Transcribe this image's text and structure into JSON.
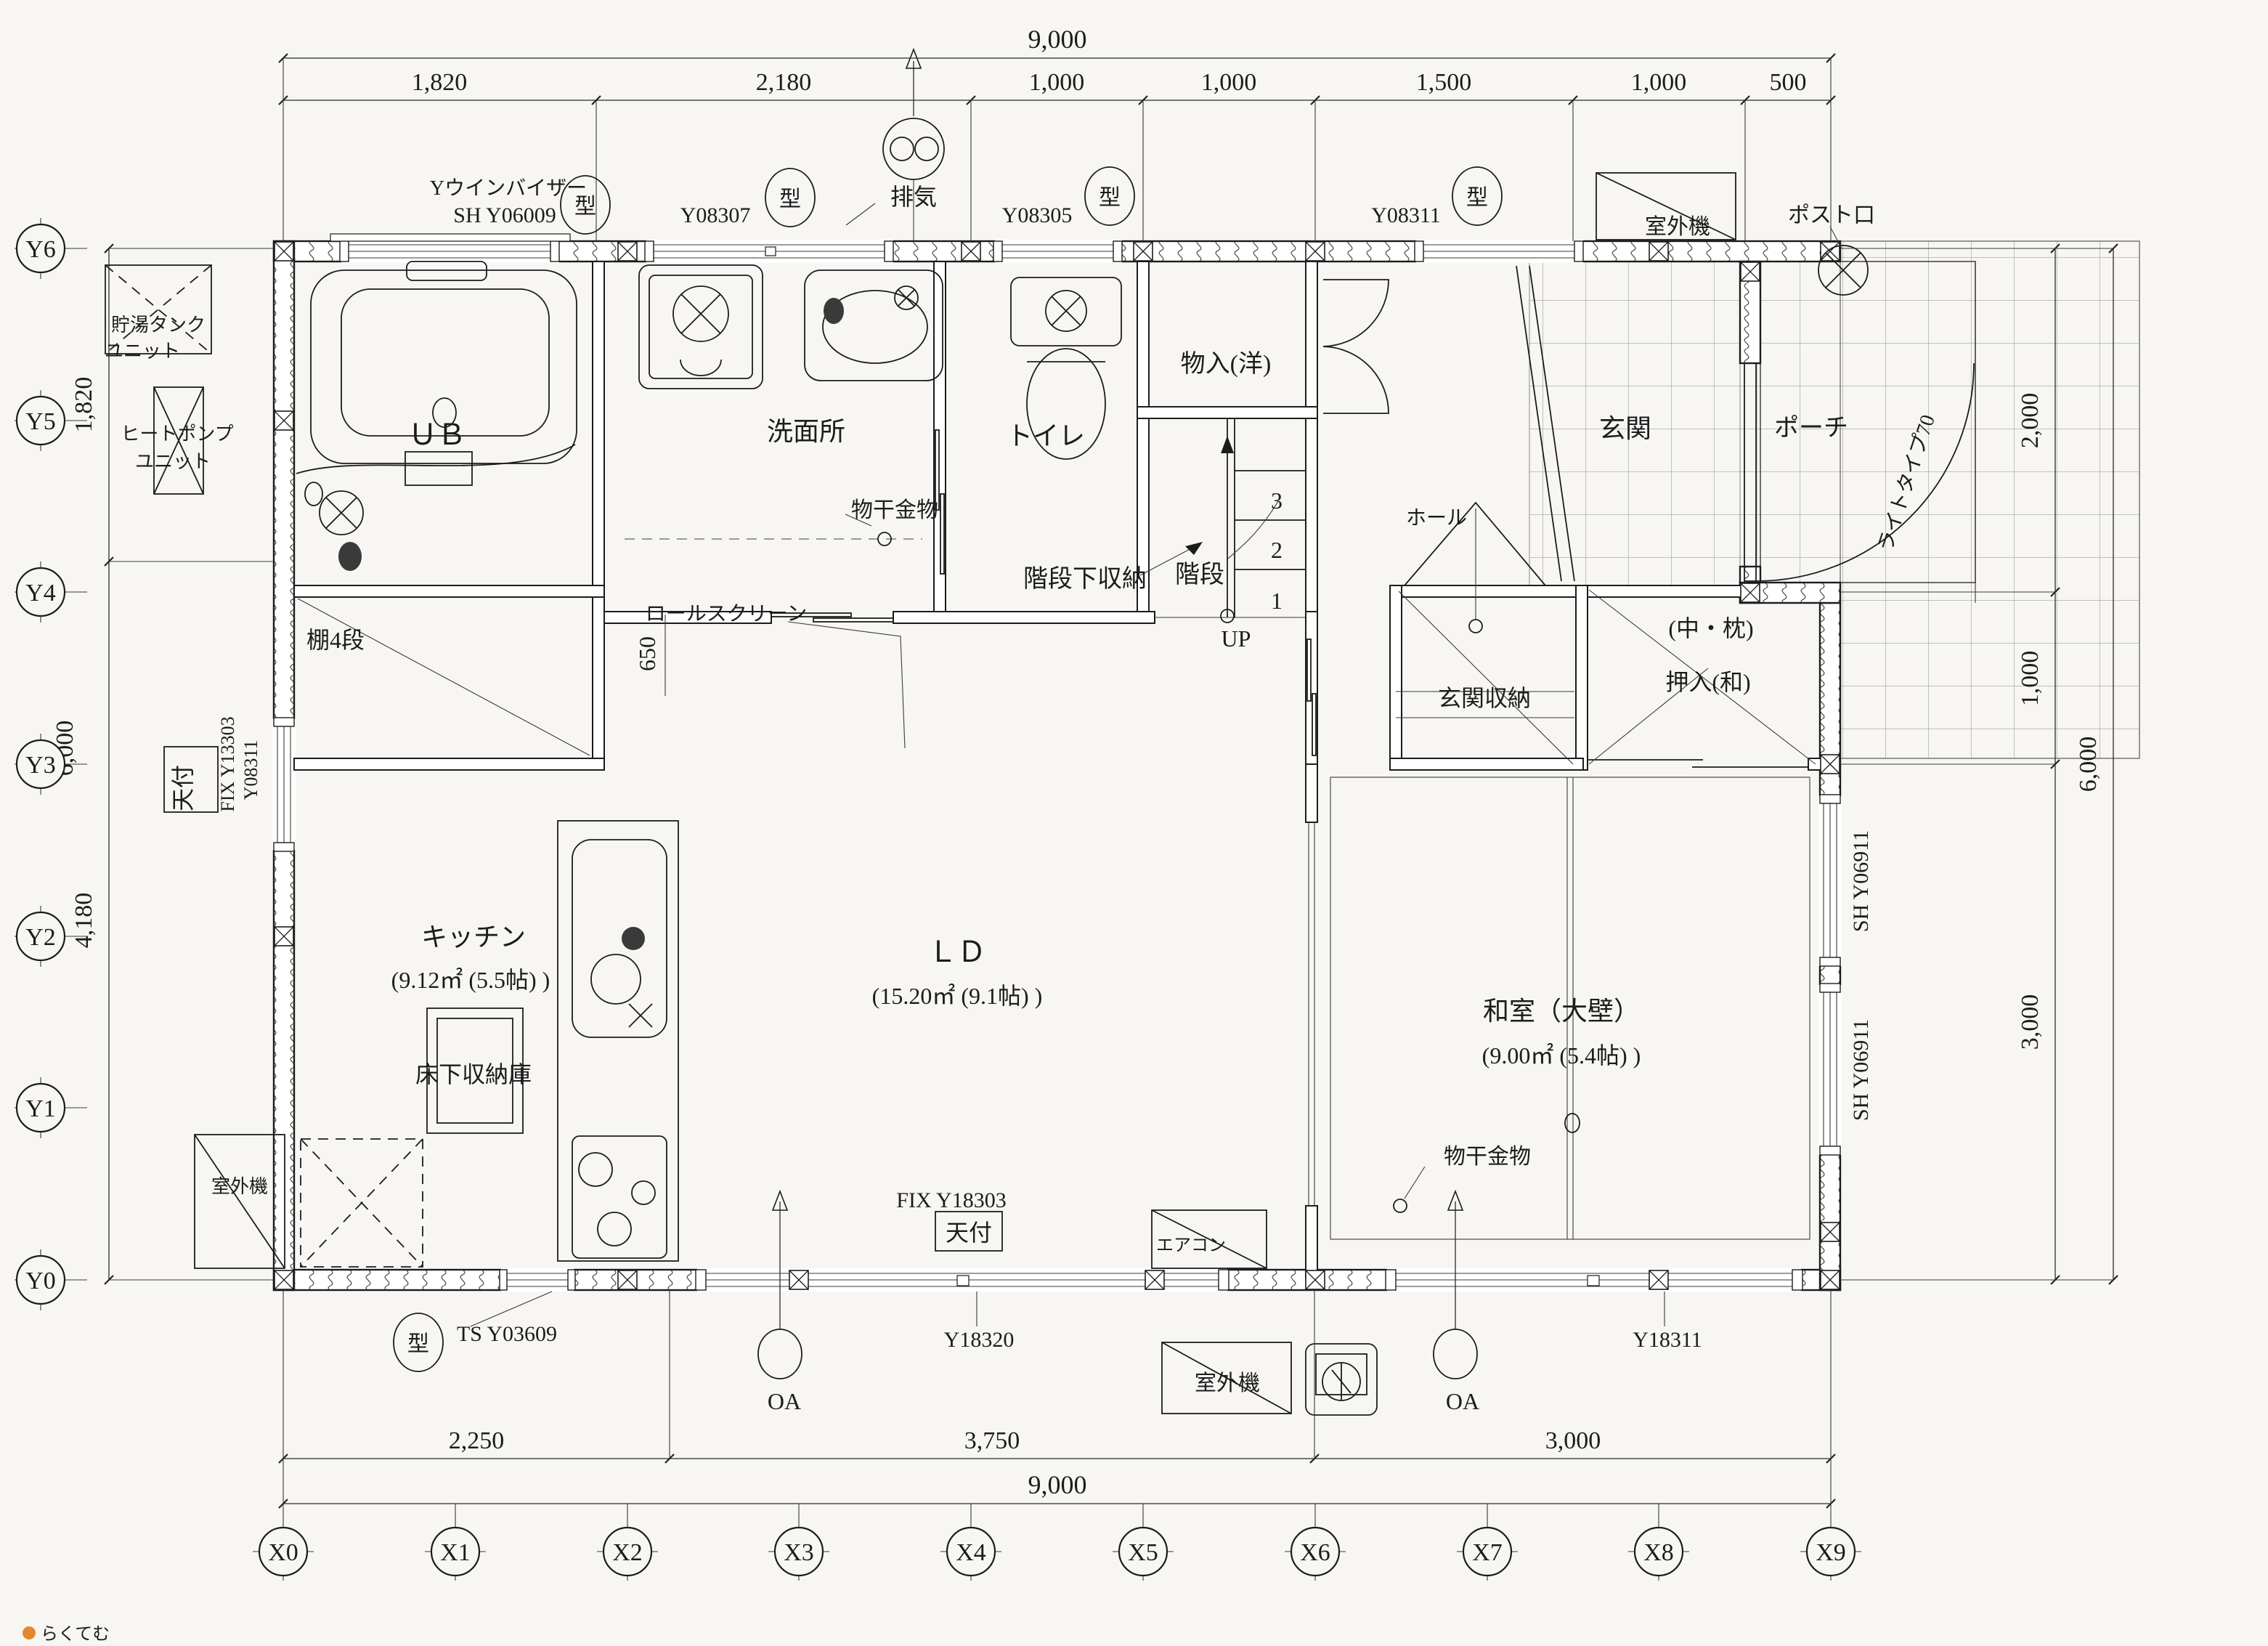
{
  "colors": {
    "paper": "#f7f6f3",
    "ink": "#1c1c1c",
    "tile_line": "#8a8a8a",
    "logo_dot": "#e08a2d",
    "logo_text": "#a8a884"
  },
  "grid": {
    "x": [
      "X0",
      "X1",
      "X2",
      "X3",
      "X4",
      "X5",
      "X6",
      "X7",
      "X8",
      "X9"
    ],
    "y": [
      "Y6",
      "Y5",
      "Y4",
      "Y3",
      "Y2",
      "Y1",
      "Y0"
    ]
  },
  "dims": {
    "top_total": "9,000",
    "top_segments": [
      "1,820",
      "2,180",
      "1,000",
      "1,000",
      "1,500",
      "1,000",
      "500"
    ],
    "bottom_segments": [
      "2,250",
      "3,750",
      "3,000"
    ],
    "bottom_total": "9,000",
    "left_segments": [
      "1,820",
      "4,180"
    ],
    "left_total": "6,000",
    "right_segments": [
      "2,000",
      "1,000",
      "3,000"
    ],
    "right_total": "6,000",
    "stair_width": "650"
  },
  "rooms": {
    "ub": "ＵＢ",
    "senmenjo": "洗面所",
    "toilet": "トイレ",
    "mono_iri": "物入(洋)",
    "kaidan": "階段",
    "kaidan_shita": "階段下収納",
    "hall": "ホール",
    "genkan": "玄関",
    "porch": "ポーチ",
    "kitchen": "キッチン",
    "kitchen_area": "(9.12㎡ (5.5帖) )",
    "ld": "ＬＤ",
    "ld_area": "(15.20㎡ (9.1帖) )",
    "washitsu": "和室（大壁）",
    "washitsu_area": "(9.00㎡ (5.4帖) )",
    "genkan_shuno": "玄関収納",
    "oshiire": "押入(和)",
    "oshiire_note": "(中・枕)",
    "yukashita": "床下収納庫",
    "tana": "棚4段"
  },
  "stairs": {
    "n3": "3",
    "n2": "2",
    "n1": "1",
    "up": "UP"
  },
  "openings": {
    "visor": "Yウインバイザー",
    "sh_y06009": "SH Y06009",
    "y08307": "Y08307",
    "y08305": "Y08305",
    "y08311": "Y08311",
    "kata": "型",
    "fix_y13303": "FIX Y13303",
    "y08311_left": "Y08311",
    "sh_y06911": "SH Y06911",
    "fix_y18303": "FIX Y18303",
    "y18320": "Y18320",
    "y18311": "Y18311",
    "ts_y03609": "TS Y03609",
    "tenbari": "天付",
    "door_type": "ライトタイプ70"
  },
  "equipment": {
    "tank_line1": "貯湯タンク",
    "tank_line2": "ユニット",
    "heatpump_line1": "ヒートポンプ",
    "heatpump_line2": "ユニット",
    "outdoor_unit": "室外機",
    "aircon": "エアコン",
    "exhaust": "排気",
    "post_slot": "ポスト口",
    "roll_screen": "ロールスクリーン",
    "monohoshi": "物干金物",
    "oa": "OA"
  },
  "watermark": {
    "text": "らくてむ"
  }
}
